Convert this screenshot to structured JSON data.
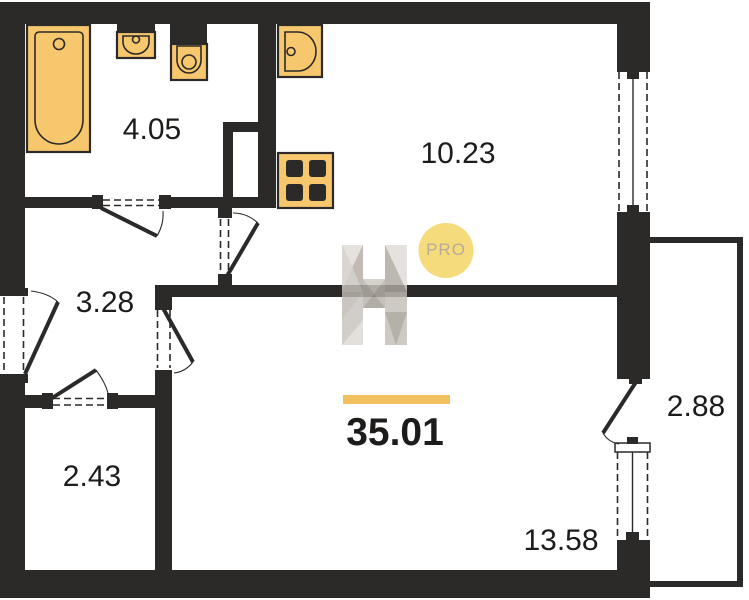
{
  "page": {
    "type": "apartment-floor-plan"
  },
  "watermark": {
    "logo_letter": "H",
    "badge_label": "PRO"
  },
  "summary": {
    "total_area": "35.01"
  },
  "rooms": [
    {
      "name": "bathroom",
      "area": "4.05"
    },
    {
      "name": "kitchen-living",
      "area": "10.23"
    },
    {
      "name": "hallway",
      "area": "3.28"
    },
    {
      "name": "storage",
      "area": "2.43"
    },
    {
      "name": "room",
      "area": "13.58"
    },
    {
      "name": "balcony",
      "area": "2.88"
    }
  ],
  "colors": {
    "wall": "#2b2a28",
    "fixture": "#f7c76e",
    "accent_bar": "#f2c05e",
    "badge_bg": "#f6db7d",
    "badge_text": "#b5ab99",
    "label_text": "#1d1c1a"
  }
}
